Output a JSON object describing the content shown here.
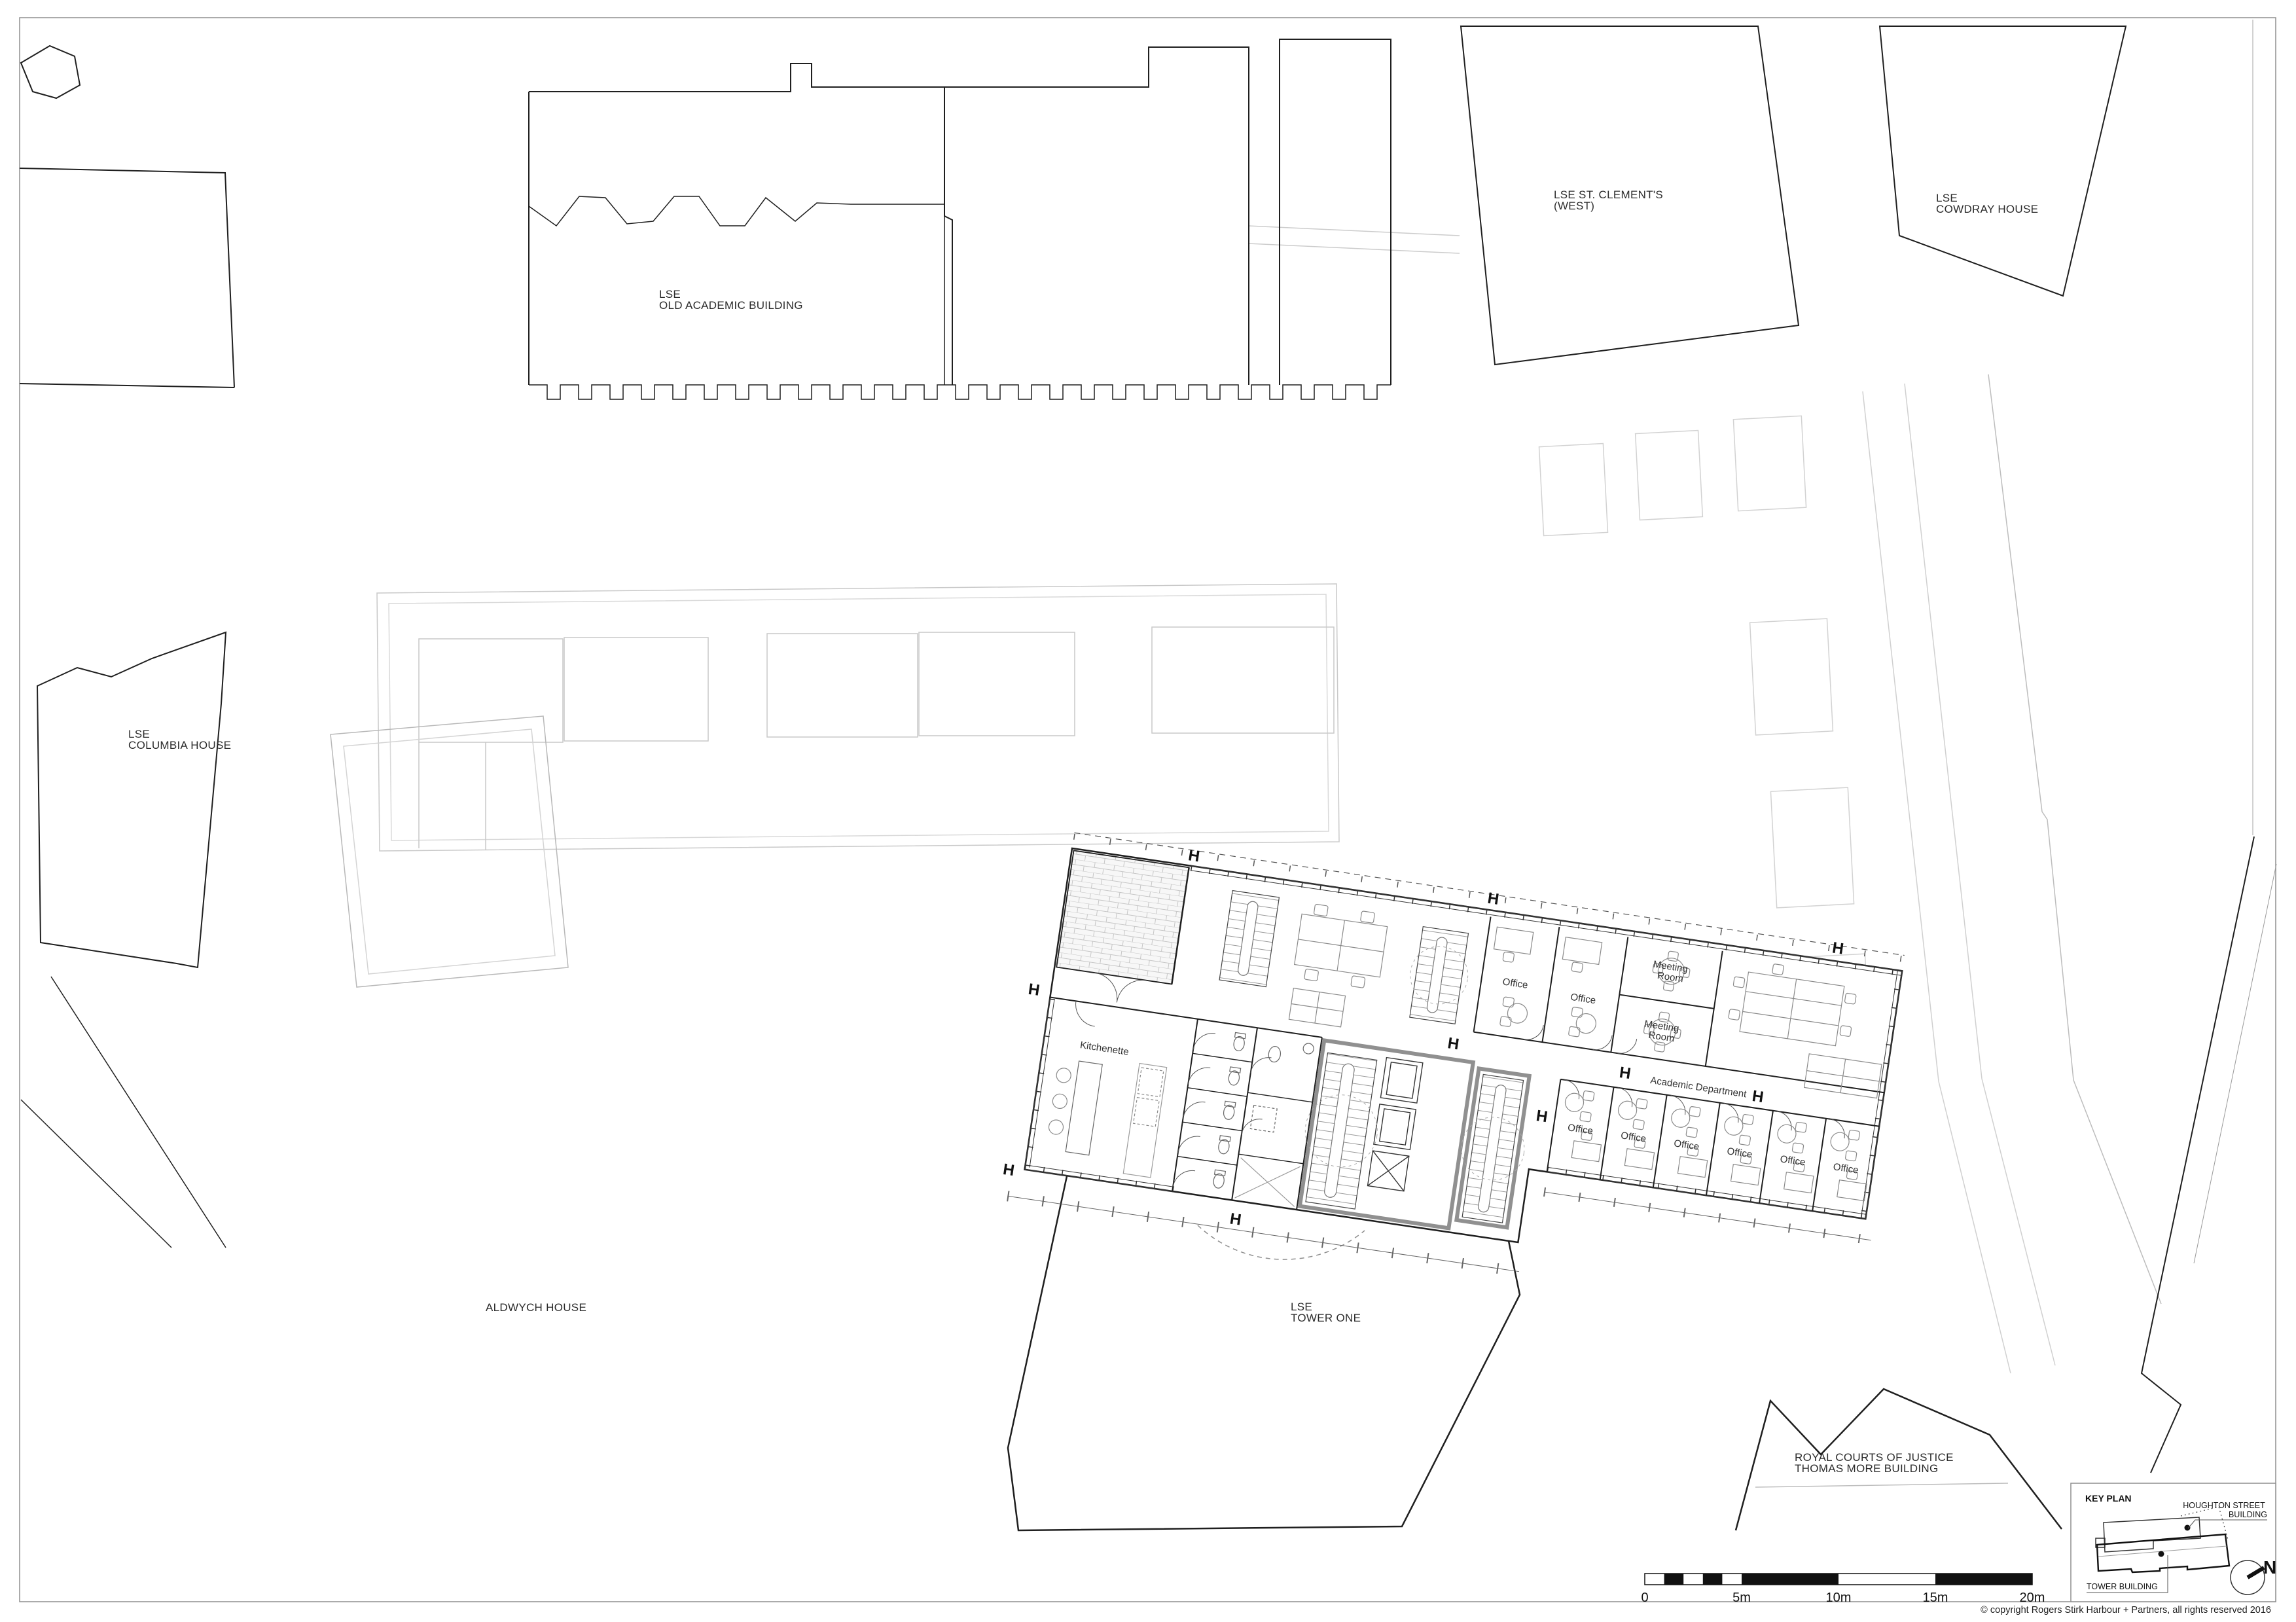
{
  "page": {
    "copyright": "© copyright  Rogers Stirk Harbour + Partners, all rights reserved 2016"
  },
  "site_labels": {
    "old_academic": [
      "LSE",
      "OLD ACADEMIC BUILDING"
    ],
    "st_clements": [
      "LSE ST. CLEMENT'S",
      "(WEST)"
    ],
    "cowdray": [
      "LSE",
      "COWDRAY HOUSE"
    ],
    "columbia": [
      "LSE",
      "COLUMBIA HOUSE"
    ],
    "aldwych": "ALDWYCH HOUSE",
    "tower_one": [
      "LSE",
      "TOWER ONE"
    ],
    "royal_courts": [
      "ROYAL COURTS OF JUSTICE",
      "THOMAS MORE BUILDING"
    ]
  },
  "plan_labels": {
    "kitchenette": "Kitchenette",
    "office": "Office",
    "meeting_room": [
      "Meeting",
      "Room"
    ],
    "academic_department": "Academic Department",
    "column_marker": "H"
  },
  "scale_bar": {
    "ticks": [
      "0",
      "5m",
      "10m",
      "15m",
      "20m"
    ]
  },
  "key_plan": {
    "title": "KEY PLAN",
    "houghton_label": [
      "HOUGHTON STREET",
      "BUILDING"
    ],
    "tower_label": "TOWER BUILDING",
    "north": "N"
  }
}
